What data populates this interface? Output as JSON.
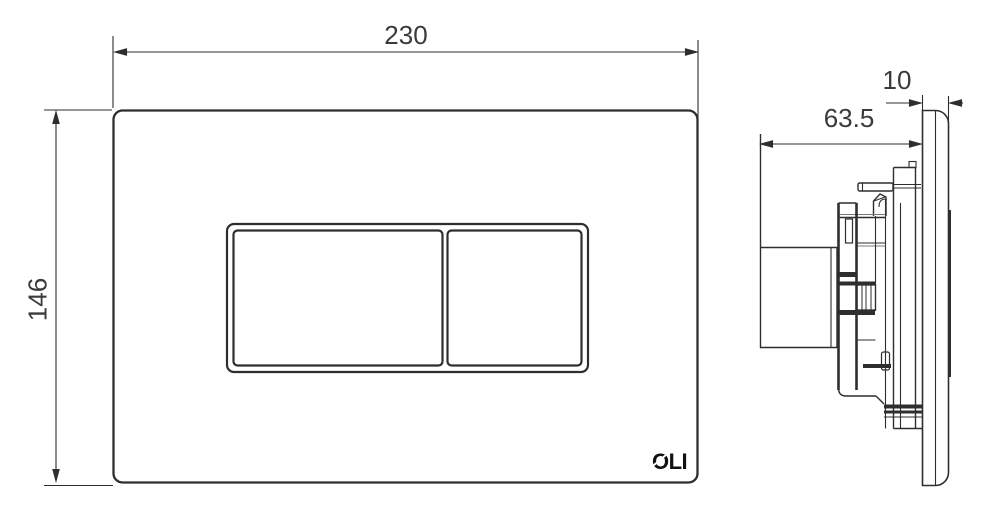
{
  "drawing": {
    "front_view": {
      "width_label": "230",
      "height_label": "146",
      "logo": "OLI"
    },
    "side_view": {
      "depth_label": "63.5",
      "thickness_label": "10"
    },
    "colors": {
      "line": "#2e2e2e",
      "text": "#3a3a3a",
      "logo": "#111111",
      "background": "#ffffff"
    }
  }
}
